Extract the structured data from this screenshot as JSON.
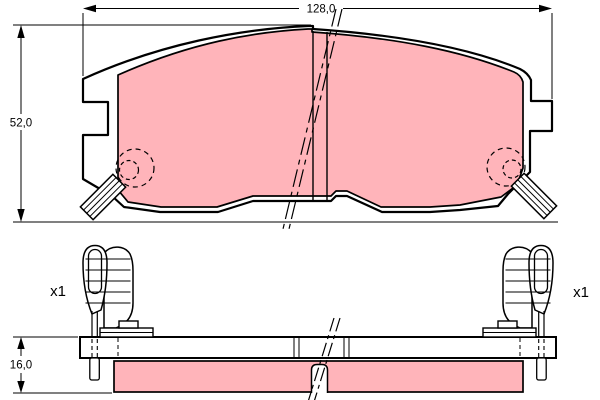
{
  "colors": {
    "friction": "#ffb4ba",
    "line": "#000000",
    "background": "#ffffff"
  },
  "top_view": {
    "width_dimension_label": "128,0",
    "height_dimension_label": "52,0"
  },
  "side_view": {
    "thickness_dimension_label": "16,0",
    "left_clip_quantity_label": "x1",
    "right_clip_quantity_label": "x1"
  }
}
